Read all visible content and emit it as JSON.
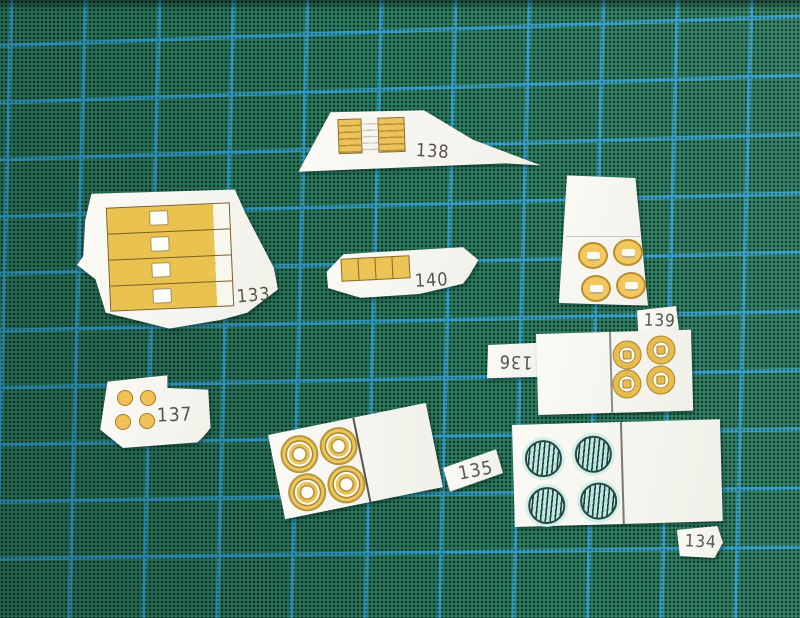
{
  "scene": {
    "subject": "paper model cutout parts on a cutting mat",
    "mat_base_color": "#2e7d60",
    "mat_dot_color": "#0e4133",
    "grid_line_color": "#34a1cd",
    "paper_color": "#f5f4ee",
    "detail_yellow": "#ecc355",
    "detail_yellow_dark": "#8a6c26",
    "detail_teal": "#bce7de",
    "detail_teal_dark": "#2a4744",
    "label_text_color": "#56544c"
  },
  "pieces": [
    {
      "label": "133"
    },
    {
      "label": "134"
    },
    {
      "label": "135"
    },
    {
      "label": "136"
    },
    {
      "label": "137"
    },
    {
      "label": "138"
    },
    {
      "label": "139"
    },
    {
      "label": "140"
    }
  ]
}
